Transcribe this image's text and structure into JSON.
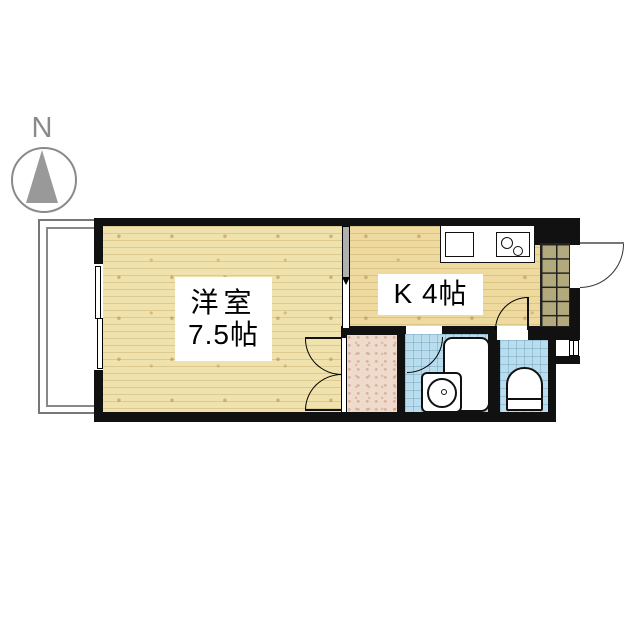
{
  "compass": {
    "direction_label": "N"
  },
  "rooms": {
    "western_room": {
      "name": "洋室",
      "size": "7.5帖"
    },
    "kitchen": {
      "name": "K 4帖"
    }
  },
  "fixtures": [
    "balcony",
    "sliding-window",
    "closet",
    "unit-bath",
    "bathtub",
    "washbasin",
    "toilet",
    "kitchen-sink",
    "stove",
    "entrance-tile",
    "entrance-door"
  ],
  "colors": {
    "wall": "#111111",
    "wood_floor": "#f0e2ad",
    "kitchen_floor": "#eeda9f",
    "bath_tile": "#b9dded",
    "closet_floor": "#eedbcc",
    "entrance_tile": "#b2a97d",
    "compass_gray": "#8a8a8a"
  }
}
